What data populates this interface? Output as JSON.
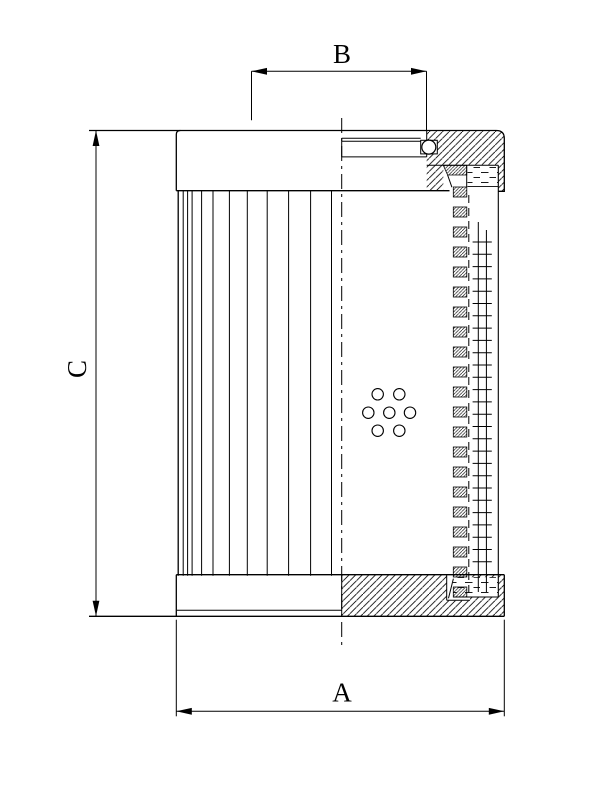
{
  "dimensions": {
    "a": {
      "label": "A"
    },
    "b": {
      "label": "B"
    },
    "c": {
      "label": "C"
    }
  },
  "colors": {
    "line": "#000000",
    "background": "#ffffff"
  }
}
